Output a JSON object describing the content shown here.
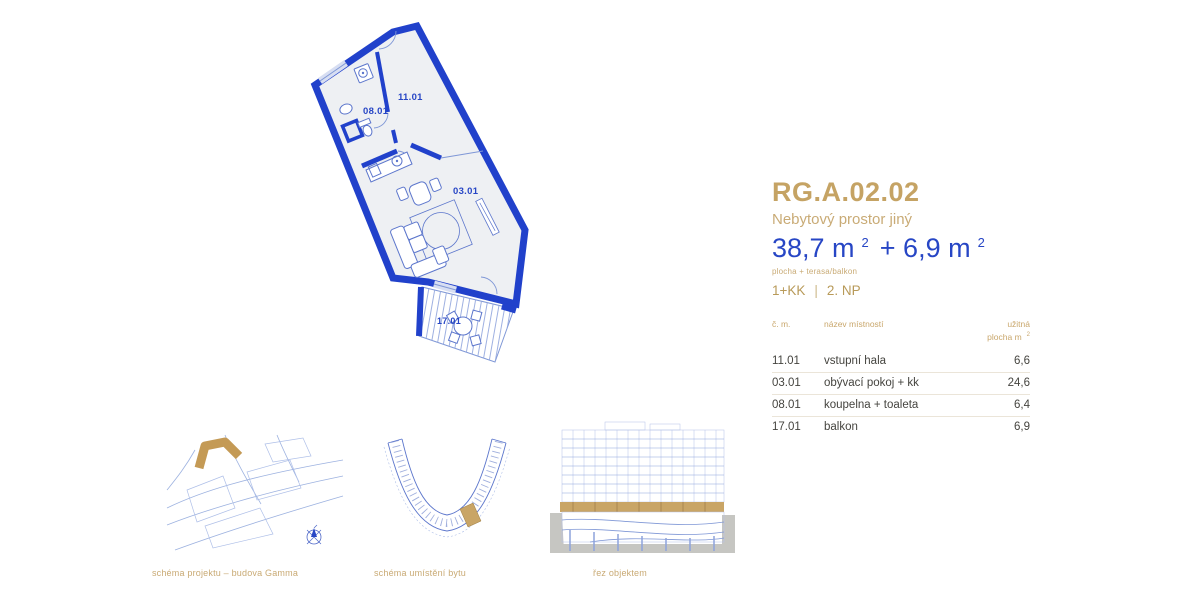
{
  "unit": {
    "code": "RG.A.02.02",
    "type_label": "Nebytový prostor jiný",
    "area_value": "38,7 m",
    "area_sup": "2",
    "area_value2": "+ 6,9 m",
    "area_sup2": "2",
    "area_note": "plocha + terasa/balkon",
    "layout": "1+KK",
    "separator": "|",
    "floor": "2. NP"
  },
  "rooms_table": {
    "header": {
      "number": "č. m.",
      "name": "název místností",
      "area_line1": "užitná",
      "area_line2": "plocha m",
      "area_sup": "2"
    },
    "rows": [
      {
        "number": "11.01",
        "name": "vstupní hala",
        "area": "6,6"
      },
      {
        "number": "03.01",
        "name": "obývací pokoj + kk",
        "area": "24,6"
      },
      {
        "number": "08.01",
        "name": "koupelna + toaleta",
        "area": "6,4"
      },
      {
        "number": "17.01",
        "name": "balkon",
        "area": "6,9"
      }
    ]
  },
  "floorplan": {
    "labels": {
      "hall": "11.01",
      "bathroom": "08.01",
      "living": "03.01",
      "balcony": "17.01"
    }
  },
  "schematics": {
    "project": {
      "caption": "schéma projektu – budova Gamma"
    },
    "location": {
      "caption": "schéma umístění bytu"
    },
    "section": {
      "caption": "řez objektem"
    }
  },
  "colors": {
    "gold": "#c5a364",
    "gold_light": "#c9ab76",
    "blue_text": "#2746c5",
    "wall_blue": "#2141cb",
    "line_blue": "#7f97d6",
    "ground_gray": "#c6c6c2"
  }
}
